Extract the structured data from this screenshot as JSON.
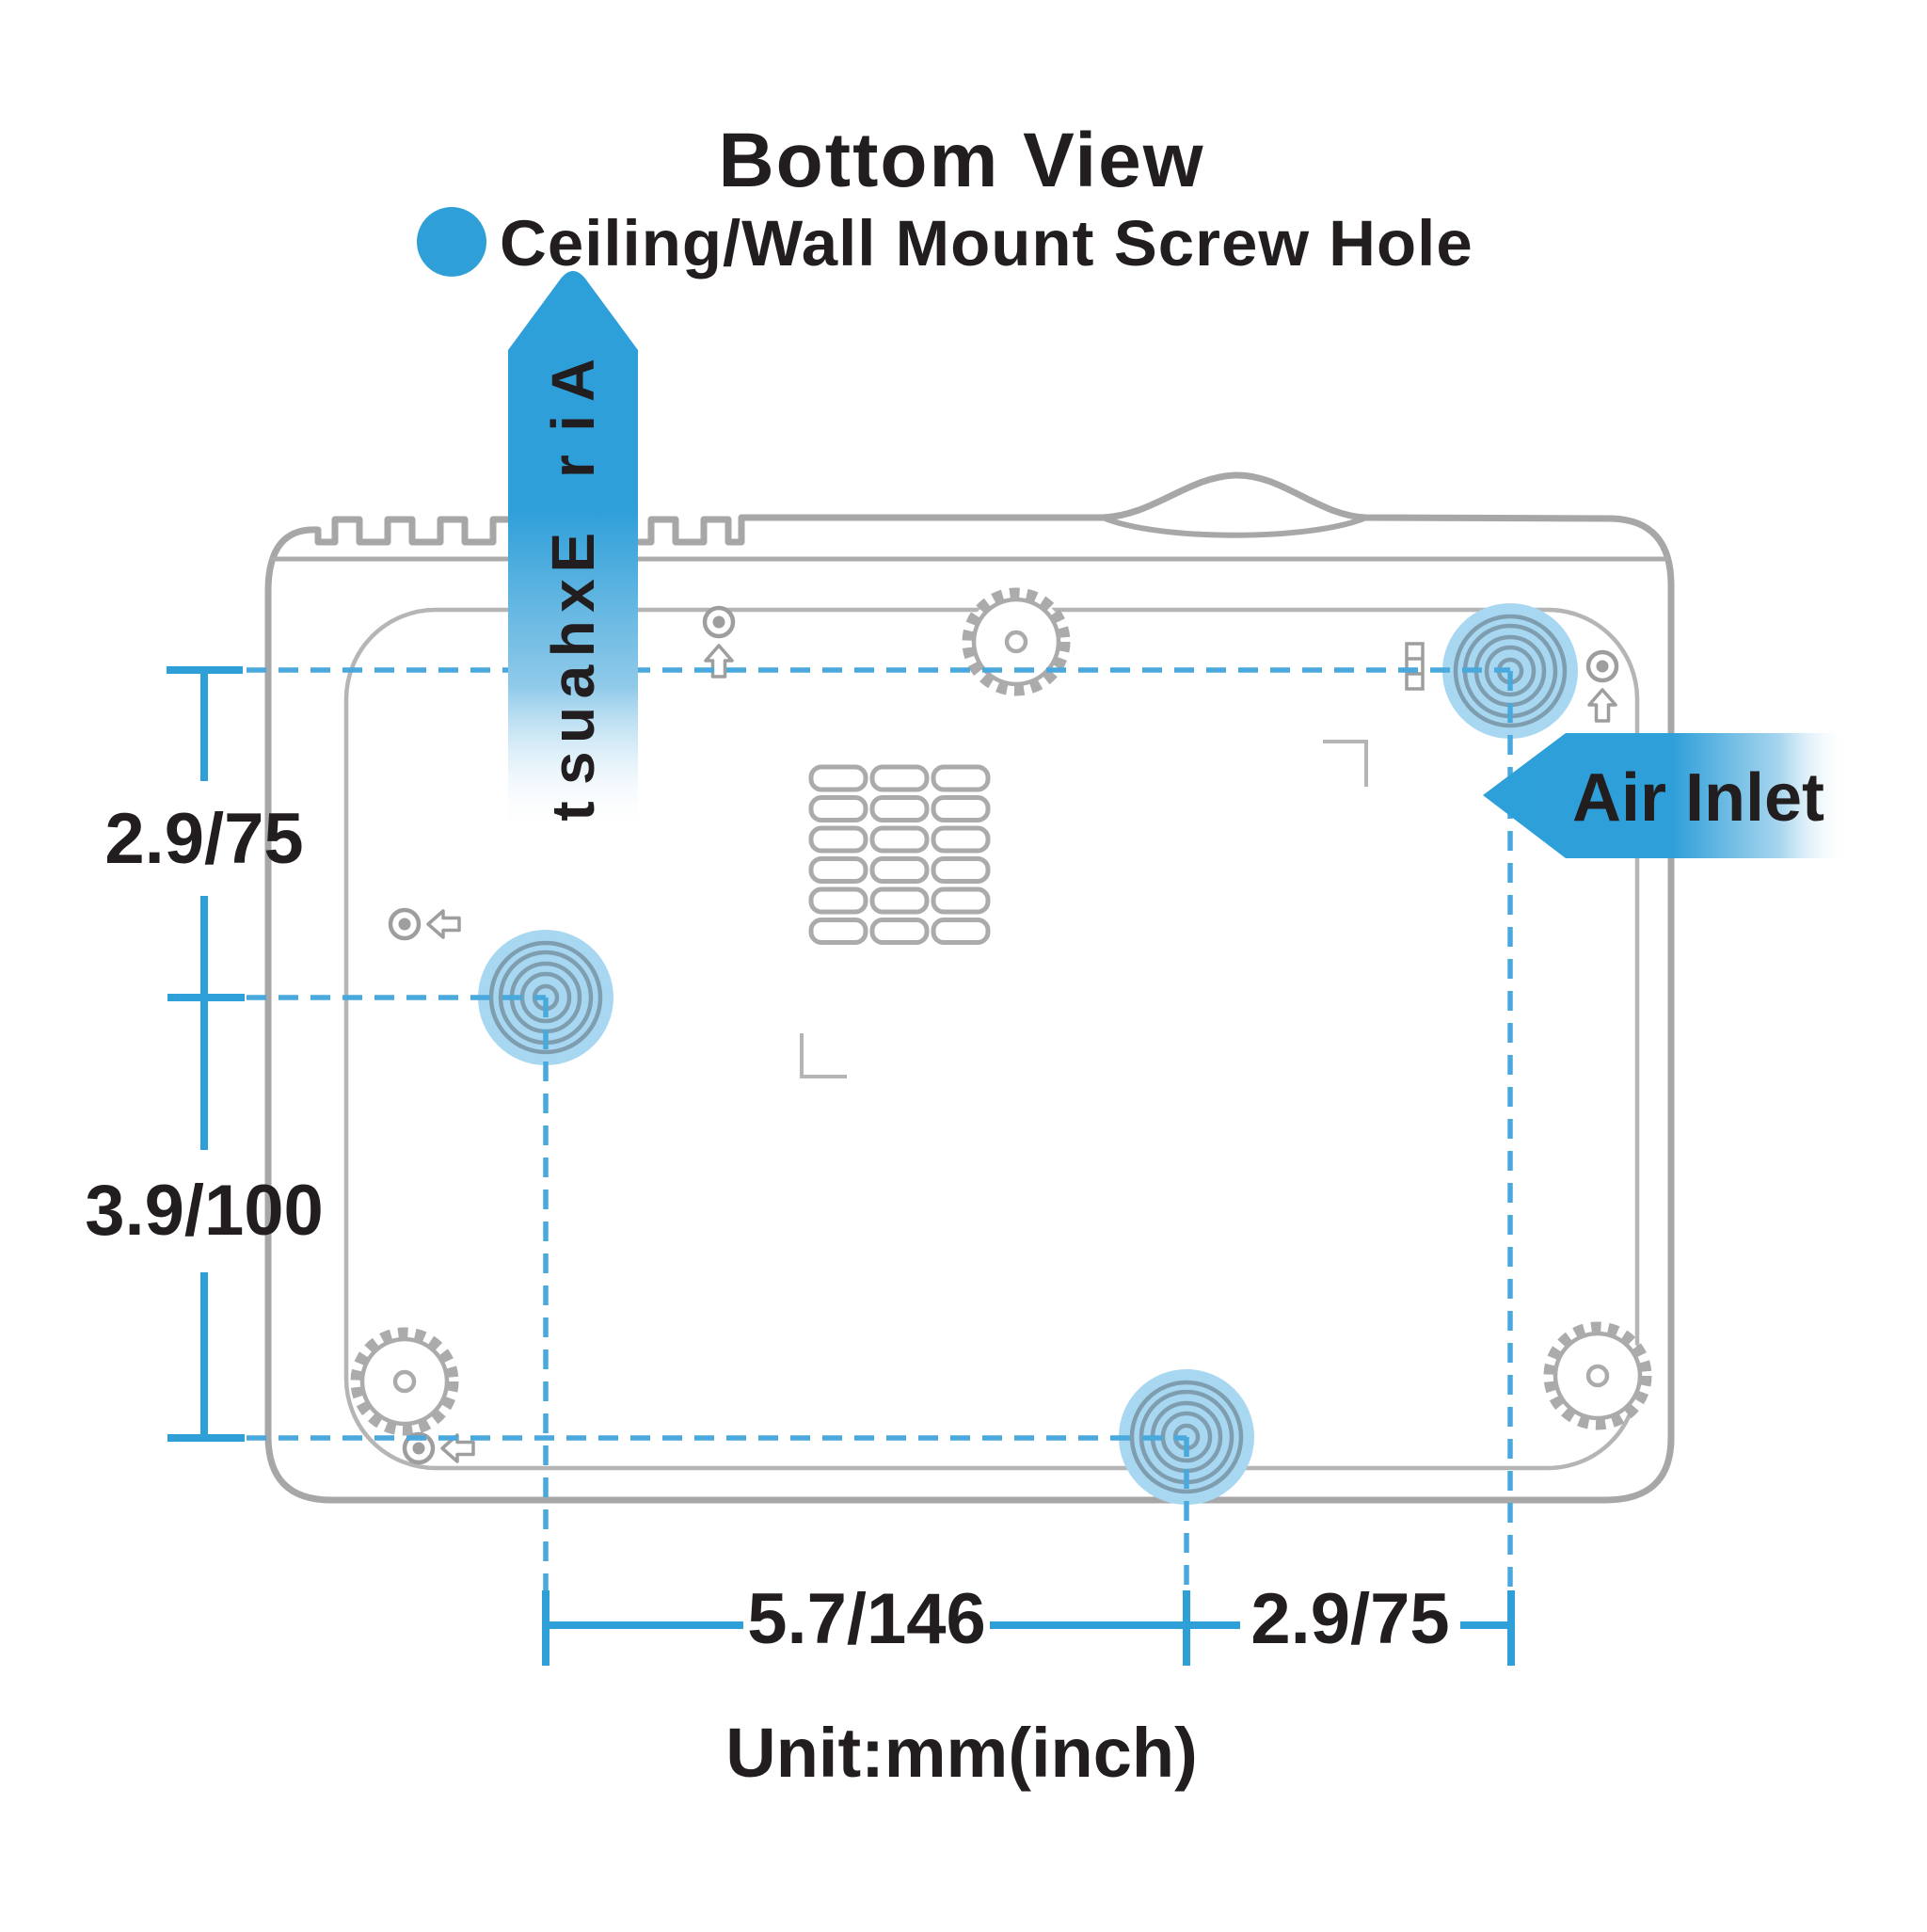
{
  "title": "Bottom View",
  "legend": {
    "label": "Ceiling/Wall Mount Screw Hole",
    "dot_color": "#2F9FD8"
  },
  "labels": {
    "air_exhaust": "Air Exhaust",
    "air_inlet": "Air Inlet",
    "unit": "Unit:mm(inch)"
  },
  "dimensions": {
    "left_top": "2.9/75",
    "left_bottom": "3.9/100",
    "bottom_left": "5.7/146",
    "bottom_right": "2.9/75"
  },
  "screw_holes": [
    {
      "position": "top-right"
    },
    {
      "position": "middle-left"
    },
    {
      "position": "bottom-center"
    }
  ],
  "colors": {
    "accent_blue": "#2F9FD8",
    "dashed_blue": "#4AA9DC",
    "hole_highlight": "#A8D7F1",
    "hole_rings": "#7E9DAF",
    "outline_gray": "#A7A7A7",
    "inner_gray": "#B5B5B5",
    "icon_gray": "#9E9E9E",
    "text_black": "#221E1F"
  }
}
